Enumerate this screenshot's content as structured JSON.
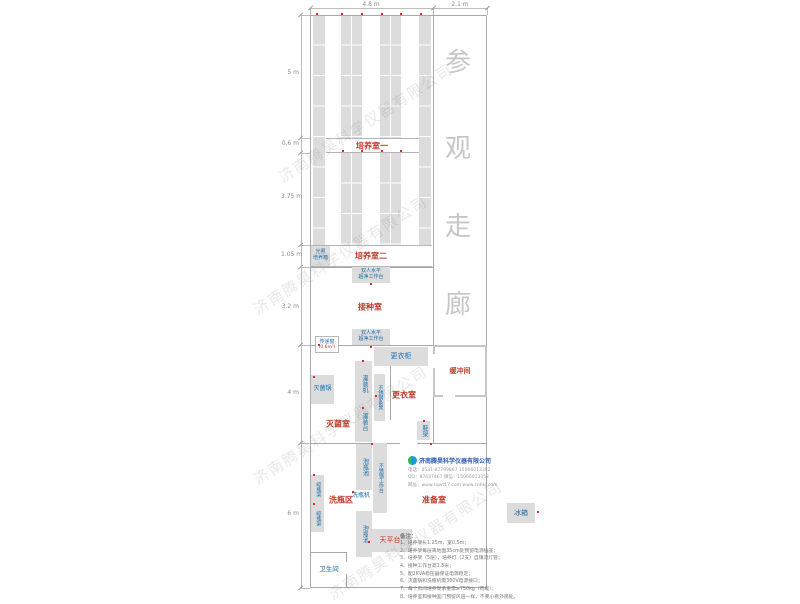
{
  "colors": {
    "room_label": "#c0392b",
    "equipment_label": "#1b6ca8",
    "shelf_fill": "#dcdcdc",
    "wall": "#a9a9a9",
    "red_dot": "#d42b2b",
    "corridor_text": "#c6c6c6",
    "watermark": "rgba(110,110,110,0.16)"
  },
  "corridor": {
    "chars": [
      "参",
      "观",
      "走",
      "廊"
    ],
    "x": 445,
    "ys": [
      42,
      128,
      206,
      284
    ]
  },
  "room_labels": [
    {
      "name": "culture-room-1",
      "label": "培养室一",
      "cx": 372,
      "cy": 146,
      "fs": 8
    },
    {
      "name": "culture-room-2",
      "label": "培养室二",
      "cx": 371,
      "cy": 256,
      "fs": 8
    },
    {
      "name": "inoculation-room",
      "label": "接种室",
      "cx": 370,
      "cy": 307,
      "fs": 8
    },
    {
      "name": "changing-room",
      "label": "更衣室",
      "cx": 404,
      "cy": 395,
      "fs": 8
    },
    {
      "name": "sterilization-room",
      "label": "灭菌室",
      "cx": 338,
      "cy": 424,
      "fs": 8
    },
    {
      "name": "buffer-room",
      "label": "缓冲间",
      "cx": 460,
      "cy": 371,
      "fs": 7
    },
    {
      "name": "bottle-washing-area",
      "label": "洗瓶区",
      "cx": 341,
      "cy": 500,
      "fs": 8
    },
    {
      "name": "preparation-room",
      "label": "准备室",
      "cx": 434,
      "cy": 500,
      "fs": 8
    }
  ],
  "equipment": [
    {
      "name": "light-incubator",
      "label": "光照\n培养箱",
      "x": 311,
      "y": 246,
      "w": 19,
      "h": 20,
      "fs": 5,
      "box": true
    },
    {
      "name": "clean-bench-1",
      "label": "双人水平\n超净工作台",
      "x": 352,
      "y": 267,
      "w": 38,
      "h": 16,
      "fs": 5,
      "box": true
    },
    {
      "name": "clean-bench-2",
      "label": "双人水平\n超净工作台",
      "x": 352,
      "y": 329,
      "w": 38,
      "h": 16,
      "fs": 5,
      "box": true
    },
    {
      "name": "changing-locker",
      "label": "更衣柜",
      "x": 374,
      "y": 347,
      "w": 54,
      "h": 19,
      "fs": 7,
      "box": true
    },
    {
      "name": "filling-machine",
      "label": "灌装机",
      "x": 355,
      "y": 361,
      "w": 17,
      "h": 46,
      "fs": 6,
      "box": true,
      "v": true
    },
    {
      "name": "stainless-bench",
      "label": "不锈钢条凳",
      "x": 374,
      "y": 374,
      "w": 11,
      "h": 47,
      "fs": 5,
      "box": true,
      "v": true
    },
    {
      "name": "sterilizer-pot",
      "label": "灭菌锅",
      "x": 311,
      "y": 375,
      "w": 23,
      "h": 29,
      "fs": 6,
      "box": true
    },
    {
      "name": "filling-table",
      "label": "灌装台",
      "x": 355,
      "y": 401,
      "w": 17,
      "h": 41,
      "fs": 6,
      "box": true,
      "v": true
    },
    {
      "name": "shoe-rack",
      "label": "鞋架",
      "x": 417,
      "y": 421,
      "w": 13,
      "h": 19,
      "fs": 6,
      "box": true,
      "v": true
    },
    {
      "name": "soaking-pool-1",
      "label": "泡瓶池",
      "x": 356,
      "y": 444,
      "w": 16,
      "h": 46,
      "fs": 6,
      "box": true,
      "v": true
    },
    {
      "name": "stainless-worktable",
      "label": "不锈钢工作台",
      "x": 373,
      "y": 443,
      "w": 14,
      "h": 70,
      "fs": 5,
      "box": true,
      "v": true
    },
    {
      "name": "bottle-washer",
      "label": "洗瓶机",
      "x": 348,
      "y": 491,
      "w": 26,
      "h": 10,
      "fs": 6,
      "box": false
    },
    {
      "name": "soaking-pool-2",
      "label": "泡瓶池",
      "x": 356,
      "y": 511,
      "w": 16,
      "h": 46,
      "fs": 6,
      "box": true,
      "v": true
    },
    {
      "name": "bottle-drying-rack-1",
      "label": "晾瓶架",
      "x": 311,
      "y": 475,
      "w": 13,
      "h": 29,
      "fs": 5,
      "box": true,
      "v": true
    },
    {
      "name": "bottle-drying-rack-2",
      "label": "晾瓶架",
      "x": 311,
      "y": 504,
      "w": 13,
      "h": 28,
      "fs": 5,
      "box": true,
      "v": true
    },
    {
      "name": "balance-table",
      "label": "天平台",
      "x": 368,
      "y": 529,
      "w": 44,
      "h": 23,
      "fs": 7,
      "box": true,
      "red": true
    },
    {
      "name": "refrigerator",
      "label": "冰箱",
      "x": 507,
      "y": 503,
      "w": 28,
      "h": 20,
      "fs": 7,
      "box": true
    },
    {
      "name": "toilet-label",
      "label": "卫生间",
      "x": 311,
      "y": 564,
      "w": 36,
      "h": 12,
      "fs": 6.5,
      "box": false
    }
  ],
  "pass_window": {
    "label": "传递窗",
    "area": "(0.6m²)"
  },
  "shelf_bars": [
    {
      "x": 313,
      "y": 15,
      "w": 12,
      "h": 230,
      "mid": false
    },
    {
      "x": 419,
      "y": 15,
      "w": 12,
      "h": 230,
      "mid": false
    },
    {
      "x": 341,
      "y": 15,
      "w": 21,
      "h": 123,
      "mid": true
    },
    {
      "x": 341,
      "y": 153,
      "w": 21,
      "h": 92,
      "mid": true
    },
    {
      "x": 380,
      "y": 15,
      "w": 21,
      "h": 123,
      "mid": true
    },
    {
      "x": 380,
      "y": 153,
      "w": 21,
      "h": 92,
      "mid": true
    }
  ],
  "dims_top": {
    "labels": [
      {
        "label": "4.8 m",
        "cx": 371
      },
      {
        "label": "2.1 m",
        "cx": 460
      }
    ],
    "line": {
      "x1": 310,
      "x2": 487,
      "y": 8
    },
    "ticks_x": [
      310,
      433,
      487
    ]
  },
  "dims_left": {
    "labels": [
      {
        "label": "5 m",
        "cy": 72
      },
      {
        "label": "0.6 m",
        "cy": 143
      },
      {
        "label": "3.75 m",
        "cy": 196
      },
      {
        "label": "1.05 m",
        "cy": 254
      },
      {
        "label": "3.2 m",
        "cy": 306
      },
      {
        "label": "4 m",
        "cy": 392
      },
      {
        "label": "6 m",
        "cy": 513
      }
    ],
    "line": {
      "y1": 15,
      "y2": 588,
      "x": 301
    },
    "ticks_y": [
      15,
      138,
      153,
      245,
      267,
      345,
      443,
      588
    ]
  },
  "red_dots": [
    [
      316,
      13
    ],
    [
      341,
      13
    ],
    [
      361,
      13
    ],
    [
      381,
      13
    ],
    [
      400,
      13
    ],
    [
      420,
      13
    ],
    [
      342,
      150
    ],
    [
      361,
      150
    ],
    [
      381,
      150
    ],
    [
      400,
      150
    ],
    [
      370,
      283
    ],
    [
      318,
      344
    ],
    [
      370,
      346
    ],
    [
      362,
      360
    ],
    [
      313,
      376
    ],
    [
      375,
      395
    ],
    [
      423,
      420
    ],
    [
      362,
      407
    ],
    [
      371,
      443
    ],
    [
      430,
      443
    ],
    [
      352,
      491
    ],
    [
      313,
      474
    ],
    [
      313,
      503
    ],
    [
      368,
      541
    ],
    [
      537,
      511
    ]
  ],
  "company": {
    "name": "济南腾昊科学仪器有限公司",
    "lines": [
      "电话：0531-87799867  15066013352",
      "QQ：87437467  微信：15066013352",
      "网址：www.sqwt17.com  www.cnhkj.com"
    ]
  },
  "notes": {
    "title": "备注：",
    "items": [
      "1、培养架长1.25m，宽0.5m；",
      "2、培养架每层离地面35cm处预留电源插座；",
      "3、培养架（5层），培养灯（2支）自镇流灯管；",
      "4、接种工作台高1.5米；",
      "5、配2KVA稳压器保证电源稳定；",
      "6、灭菌锅和洗瓶机需380V电源接口；",
      "7、每个房间培养架承重需≥750kg（荷载）；",
      "8、培养室和接种室门预留风道一样，不要小看外观处。"
    ]
  },
  "watermark": {
    "text": "济南腾昊科学仪器有限公司",
    "origins": [
      [
        280,
        168
      ],
      [
        255,
        300
      ],
      [
        255,
        470
      ],
      [
        330,
        585
      ]
    ]
  }
}
